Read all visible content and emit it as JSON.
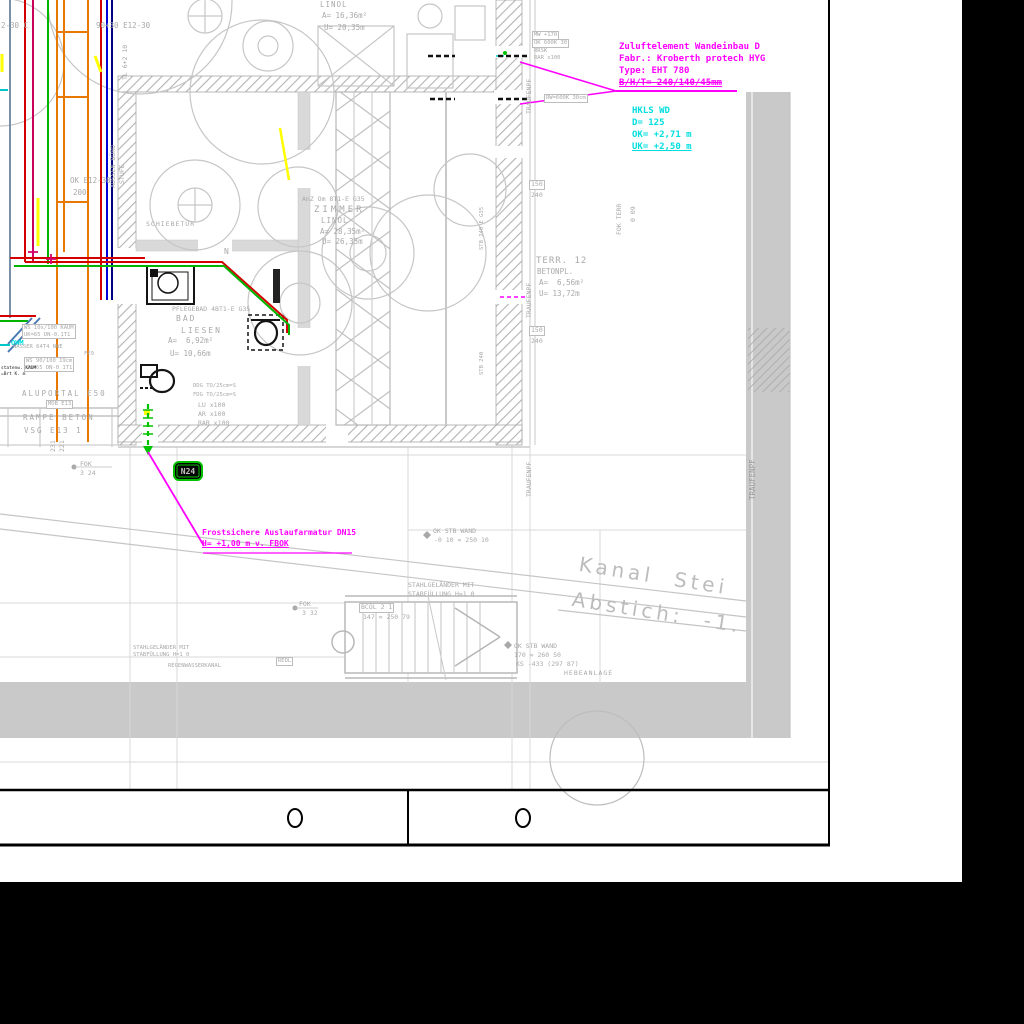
{
  "colors": {
    "magenta": "#ff00ff",
    "cyan": "#00dede",
    "cad_gray": "#a9a9a9",
    "band_gray": "#c9c9c9",
    "red": "#d40000",
    "green": "#00b400",
    "orange": "#e87800",
    "blue": "#0000d8",
    "navy": "#000080",
    "yellow": "#ffff00",
    "slate": "#7a90a8",
    "badge_green": "#00c000"
  },
  "ann": {
    "zuluft": {
      "l1": "Zuluftelement Wandeinbau D",
      "l2": "Fabr.: Kroberth protech HYG",
      "l3": "Type: EHT 780",
      "l4": "B/H/T= 240/140/45mm"
    },
    "hkls": {
      "l1": "HKLS WD",
      "l2": "D= 125",
      "l3": "OK= +2,71 m",
      "l4": "UK= +2,50 m"
    },
    "frost": {
      "l1": "Frostsichere Auslaufarmatur DN15",
      "l2": "H= +1,00 m v. FBOK"
    },
    "terr": {
      "l1": "TERR. 12",
      "l2": "BETONPL.",
      "l3": "A=  6,56m²",
      "l4": "U= 13,72m"
    },
    "kanal": {
      "l1": "Kanal  Stei",
      "l2": "Abstich:  -1."
    },
    "n24": "N24",
    "owm": "OWM"
  },
  "rooms": {
    "linol": {
      "name": "LINOL",
      "a": "A= 16,36m²",
      "u": "U= 20,35m"
    },
    "zimmer": {
      "code": "AnZ Om 8T1-E G35",
      "name": "ZIMMER",
      "floor": "LINOL",
      "a": "A= 28,35m²",
      "u": "U= 26,35m"
    },
    "bad": {
      "code": "PFLEGEBAD 4BT1-E G35",
      "name": "BAD",
      "name2": "LIESEN",
      "a": "A=  6,92m²",
      "u": "U= 10,66m"
    },
    "door": "SCHIEBETÜR"
  },
  "left": {
    "c1": "2-30 C",
    "c2": "90+30 E12-30",
    "tl": "TL 6+2 10",
    "v1": "AUSSEN BÜRO",
    "v2": "STUFE",
    "ok": "OK E12-30",
    "n200": "200",
    "ws1a": "WS 10x/100 KAUM",
    "ws1b": "UK=65 DN-0.1T1",
    "wasser": "WASSER 64T4 NWE",
    "fe9": "FE9",
    "ws2a": "WS 90/100 19cm",
    "ws2b": "UK=65 DN-0 1T1",
    "blk1": "statenw. KAUM",
    "blk2": "=Brt K. m",
    "alu": "ALUPORTAL E50",
    "mob": "MOB E13",
    "rampe": "RAMPE BETON",
    "vsg": "VSG E13 1",
    "n231": "231",
    "n221": "221",
    "fok": "FOK",
    "fokv": "3 24"
  },
  "mid": {
    "ddg": "DDG TO/25cm=S",
    "fdg": "FDG TO/25cm=S",
    "lu": "LU x100",
    "ar": "AR x100",
    "rar": "RAR x100",
    "north": "N"
  },
  "right": {
    "mw": "MW +170",
    "ok600": "OK 600K 30",
    "rrsk": "RRSK",
    "rarx": "RAR x100",
    "rw": "RW=600K 30cm",
    "trauf": "TRAUFENPF",
    "b150": "150",
    "b240": "240",
    "stb1": "STB 240 E G35",
    "stb2": "STB 240",
    "fokterr": "FOK TERR",
    "v009": "0 09"
  },
  "bottom": {
    "okstb1a": "OK STB WAND",
    "okstb1b": "-0 10 = 250 10",
    "rail1": "STAHLGELÄNDER MIT",
    "rail2": "STABFÜLLUNG H=1 0",
    "bcol": "BCOL 2 1",
    "steps": "147 = 250 79",
    "fok": "FOK",
    "fokv": "3 32",
    "okstb2b": "170 = 260 50",
    "okstb2c": "KS -433 (297 87)",
    "hebe": "HEBEANLAGE",
    "redl": "REDL",
    "kanal2": "REGENWASSERKANAL"
  }
}
